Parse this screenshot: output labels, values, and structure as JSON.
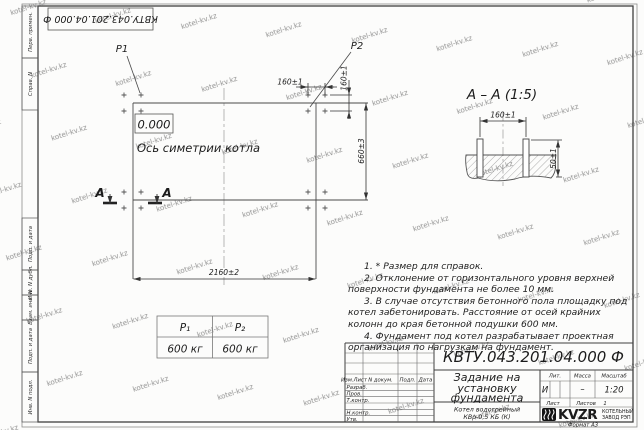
{
  "page": {
    "format_label": "Формат А3"
  },
  "watermark": "kotel-kv.kz",
  "margins": {
    "top_stamp": "КВТУ.043.201.04.000 Ф",
    "left_labels": [
      "Перв. примен.",
      "Справ. N",
      "Подп. и дата",
      "Инв. N дубл.",
      "Взам. инв. N",
      "Подп. и дата",
      "Инв. N подл."
    ]
  },
  "plan": {
    "p1": "P1",
    "p2": "P2",
    "elevation": "0.000",
    "axis_label": "Ось симетрии котла",
    "section_letter": "А",
    "dim_width": "2160±2",
    "dim_height": "660±3",
    "dim_spacing_h": "160±1",
    "dim_spacing_v": "160±1"
  },
  "section": {
    "title": "А – А (1:5)",
    "dim_width": "160±1",
    "dim_height": "50±1"
  },
  "loads_table": {
    "headers": [
      "P₁",
      "P₂"
    ],
    "values": [
      "600 кг",
      "600 кг"
    ]
  },
  "notes": [
    "1. * Размер для справок.",
    "2. Отклонение от горизонтального уровня верхней поверхности фундамента не более 10 мм.",
    "3. В случае отсутствия бетонного пола площадку под котел забетонировать. Расстояние от осей крайних колонн до края бетонной подушки 600 мм.",
    "4. Фундамент под котел разрабатывает проектная организация по нагрузкам на фундамент."
  ],
  "title_block": {
    "designation": "КВТУ.043.201.04.000 Ф",
    "title_lines": [
      "Задание на",
      "установку",
      "фундамента"
    ],
    "product_lines": [
      "Котел водогрейный",
      "КВр-0,5 КБ (К)"
    ],
    "header_cols": [
      "Изм.Лист",
      "N докум.",
      "Подп.",
      "Дата"
    ],
    "sig_rows": [
      "Разраб.",
      "Пров.",
      "Т.контр.",
      "Н.контр.",
      "Утв."
    ],
    "lit_header": "Лит.",
    "mass_header": "Масса",
    "scale_header": "Масштаб",
    "lit": "И",
    "mass": "–",
    "scale": "1:20",
    "sheet_label": "Лист",
    "sheets_label": "Листов",
    "sheets_count": "1",
    "logo_text": "KVZR",
    "company_lines": [
      "КОТЕЛЬНЫЙ",
      "ЗАВОД РЭП"
    ]
  }
}
